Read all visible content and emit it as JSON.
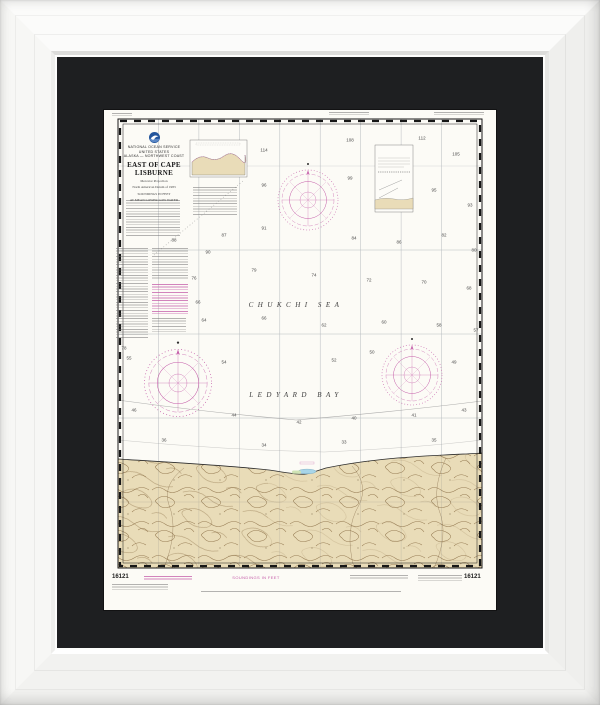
{
  "chart": {
    "number": "16121",
    "header": {
      "agency_line_1": "NATIONAL OCEAN SERVICE",
      "agency_line_2": "UNITED STATES",
      "region_line": "ALASKA — NORTHWEST COAST",
      "title": "EAST OF CAPE LISBURNE",
      "projection_line_1": "Mercator Projection",
      "projection_line_2": "North American Datum of 1983",
      "projection_line_3": "SOUNDINGS IN FEET",
      "projection_line_4": "AT MEAN LOWER LOW WATER"
    },
    "sea_labels": {
      "chukchi": "CHUKCHI SEA",
      "ledyard": "LEDYARD BAY"
    },
    "margin": {
      "number_left": "16121",
      "number_right": "16121",
      "soundings_label": "SOUNDINGS IN FEET"
    },
    "colors": {
      "magenta": "#c45ba8",
      "land_tan": "#e9dcb8",
      "contour_brown": "#8d7148",
      "lagoon_blue": "#a8d5e8",
      "marsh_green": "#cfe3b4",
      "mat_black": "#1e1f21",
      "frame_white": "#f6f6f5"
    },
    "soundings": [
      {
        "x": 160,
        "y": 40,
        "v": "114"
      },
      {
        "x": 246,
        "y": 30,
        "v": "108"
      },
      {
        "x": 318,
        "y": 28,
        "v": "112"
      },
      {
        "x": 352,
        "y": 44,
        "v": "105"
      },
      {
        "x": 160,
        "y": 75,
        "v": "96"
      },
      {
        "x": 246,
        "y": 68,
        "v": "99"
      },
      {
        "x": 330,
        "y": 80,
        "v": "95"
      },
      {
        "x": 366,
        "y": 95,
        "v": "93"
      },
      {
        "x": 104,
        "y": 142,
        "v": "90"
      },
      {
        "x": 70,
        "y": 130,
        "v": "88"
      },
      {
        "x": 120,
        "y": 125,
        "v": "87"
      },
      {
        "x": 160,
        "y": 118,
        "v": "91"
      },
      {
        "x": 250,
        "y": 128,
        "v": "84"
      },
      {
        "x": 295,
        "y": 132,
        "v": "86"
      },
      {
        "x": 340,
        "y": 125,
        "v": "82"
      },
      {
        "x": 370,
        "y": 140,
        "v": "80"
      },
      {
        "x": 20,
        "y": 238,
        "v": "78"
      },
      {
        "x": 90,
        "y": 168,
        "v": "76"
      },
      {
        "x": 150,
        "y": 160,
        "v": "79"
      },
      {
        "x": 210,
        "y": 165,
        "v": "74"
      },
      {
        "x": 265,
        "y": 170,
        "v": "72"
      },
      {
        "x": 320,
        "y": 172,
        "v": "70"
      },
      {
        "x": 365,
        "y": 178,
        "v": "68"
      },
      {
        "x": 94,
        "y": 192,
        "v": "66"
      },
      {
        "x": 100,
        "y": 210,
        "v": "64"
      },
      {
        "x": 160,
        "y": 208,
        "v": "66"
      },
      {
        "x": 220,
        "y": 215,
        "v": "62"
      },
      {
        "x": 280,
        "y": 212,
        "v": "60"
      },
      {
        "x": 335,
        "y": 215,
        "v": "58"
      },
      {
        "x": 372,
        "y": 220,
        "v": "57"
      },
      {
        "x": 25,
        "y": 248,
        "v": "55"
      },
      {
        "x": 120,
        "y": 252,
        "v": "54"
      },
      {
        "x": 230,
        "y": 250,
        "v": "52"
      },
      {
        "x": 268,
        "y": 242,
        "v": "50"
      },
      {
        "x": 350,
        "y": 252,
        "v": "49"
      },
      {
        "x": 30,
        "y": 300,
        "v": "46"
      },
      {
        "x": 130,
        "y": 305,
        "v": "44"
      },
      {
        "x": 195,
        "y": 312,
        "v": "42"
      },
      {
        "x": 250,
        "y": 308,
        "v": "40"
      },
      {
        "x": 310,
        "y": 305,
        "v": "41"
      },
      {
        "x": 360,
        "y": 300,
        "v": "43"
      },
      {
        "x": 60,
        "y": 330,
        "v": "36"
      },
      {
        "x": 160,
        "y": 335,
        "v": "34"
      },
      {
        "x": 240,
        "y": 332,
        "v": "33"
      },
      {
        "x": 330,
        "y": 330,
        "v": "35"
      }
    ]
  }
}
